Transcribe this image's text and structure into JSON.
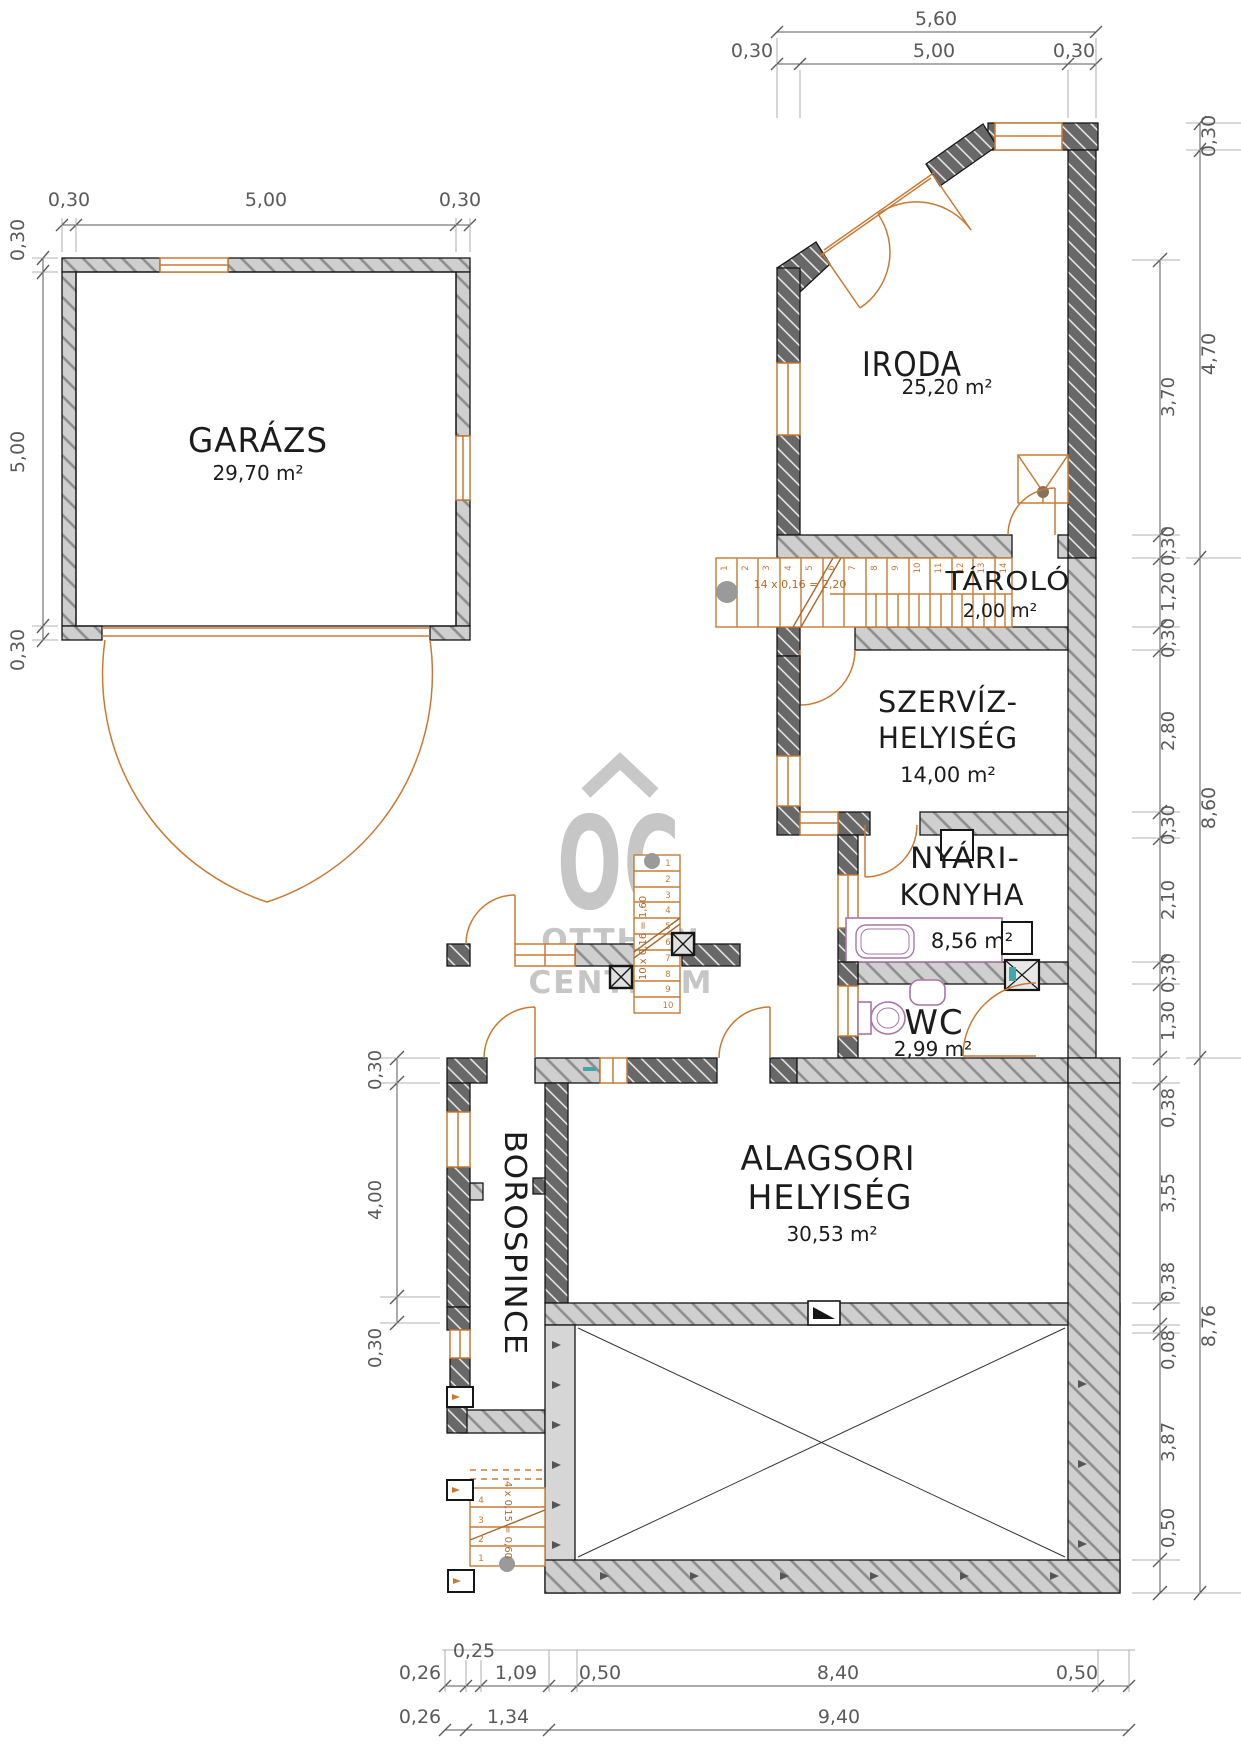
{
  "rooms": {
    "garazs": {
      "name": "GARÁZS",
      "area": "29,70 m²"
    },
    "iroda": {
      "name": "IRODA",
      "area": "25,20 m²"
    },
    "tarolo": {
      "name": "TÁROLÓ",
      "area": "2,00 m²"
    },
    "szerviz": {
      "line1": "SZERVÍZ-",
      "line2": "HELYISÉG",
      "area": "14,00 m²"
    },
    "nyari_konyha": {
      "line1": "NYÁRI-",
      "line2": "KONYHA",
      "area": "8,56 m²"
    },
    "wc": {
      "name": "WC",
      "area": "2,99 m²"
    },
    "alagsori": {
      "line1": "ALAGSORI",
      "line2": "HELYISÉG",
      "area": "30,53 m²"
    },
    "borospince": {
      "name": "BOROSPINCE"
    }
  },
  "stairs": {
    "main": {
      "label": "14 x 0,16 = 2,20",
      "steps": [
        "1",
        "2",
        "3",
        "4",
        "5",
        "6",
        "7",
        "8",
        "9",
        "10",
        "11",
        "12",
        "13",
        "14"
      ]
    },
    "outdoor": {
      "label": "10 x 0,16 = 1,60",
      "steps": [
        "1",
        "2",
        "3",
        "4",
        "5",
        "6",
        "7",
        "8",
        "9",
        "10"
      ]
    },
    "small": {
      "label": "4 x 0,15 = 0,60",
      "steps": [
        "1",
        "2",
        "3",
        "4"
      ]
    }
  },
  "watermark": {
    "monogram": "OC",
    "line1": "OTTHON",
    "line2": "CENTRUM"
  },
  "dims": {
    "garage_top": [
      "0,30",
      "5,00",
      "0,30"
    ],
    "garage_left": [
      "0,30",
      "5,00",
      "0,30"
    ],
    "top_total": "5,60",
    "top_segments": [
      "0,30",
      "5,00",
      "0,30"
    ],
    "right_totals": [
      "0,30",
      "4,70",
      "8,60",
      "8,76"
    ],
    "right_details": [
      "3,70",
      "0,30",
      "1,20",
      "0,30",
      "2,80",
      "0,30",
      "2,10",
      "0,30",
      "1,30",
      "0,38",
      "3,55",
      "0,38",
      "0,08",
      "3,87",
      "0,50"
    ],
    "left_lower": [
      "0,30",
      "4,00",
      "0,30"
    ],
    "bottom_row1": [
      "0,26",
      "0,25",
      "1,09",
      "0,50",
      "8,40",
      "0,50"
    ],
    "bottom_row2": [
      "0,26",
      "1,34",
      "9,40"
    ]
  },
  "colors": {
    "wall_dark": "#686868",
    "wall_light": "#cfcfcf",
    "accent_orange": "#c87a33",
    "fixture_purple": "#a974a9",
    "accent_teal": "#3fa8a8",
    "dim_gray": "#5a5a5a",
    "watermark_gray": "#c6c6c6"
  }
}
